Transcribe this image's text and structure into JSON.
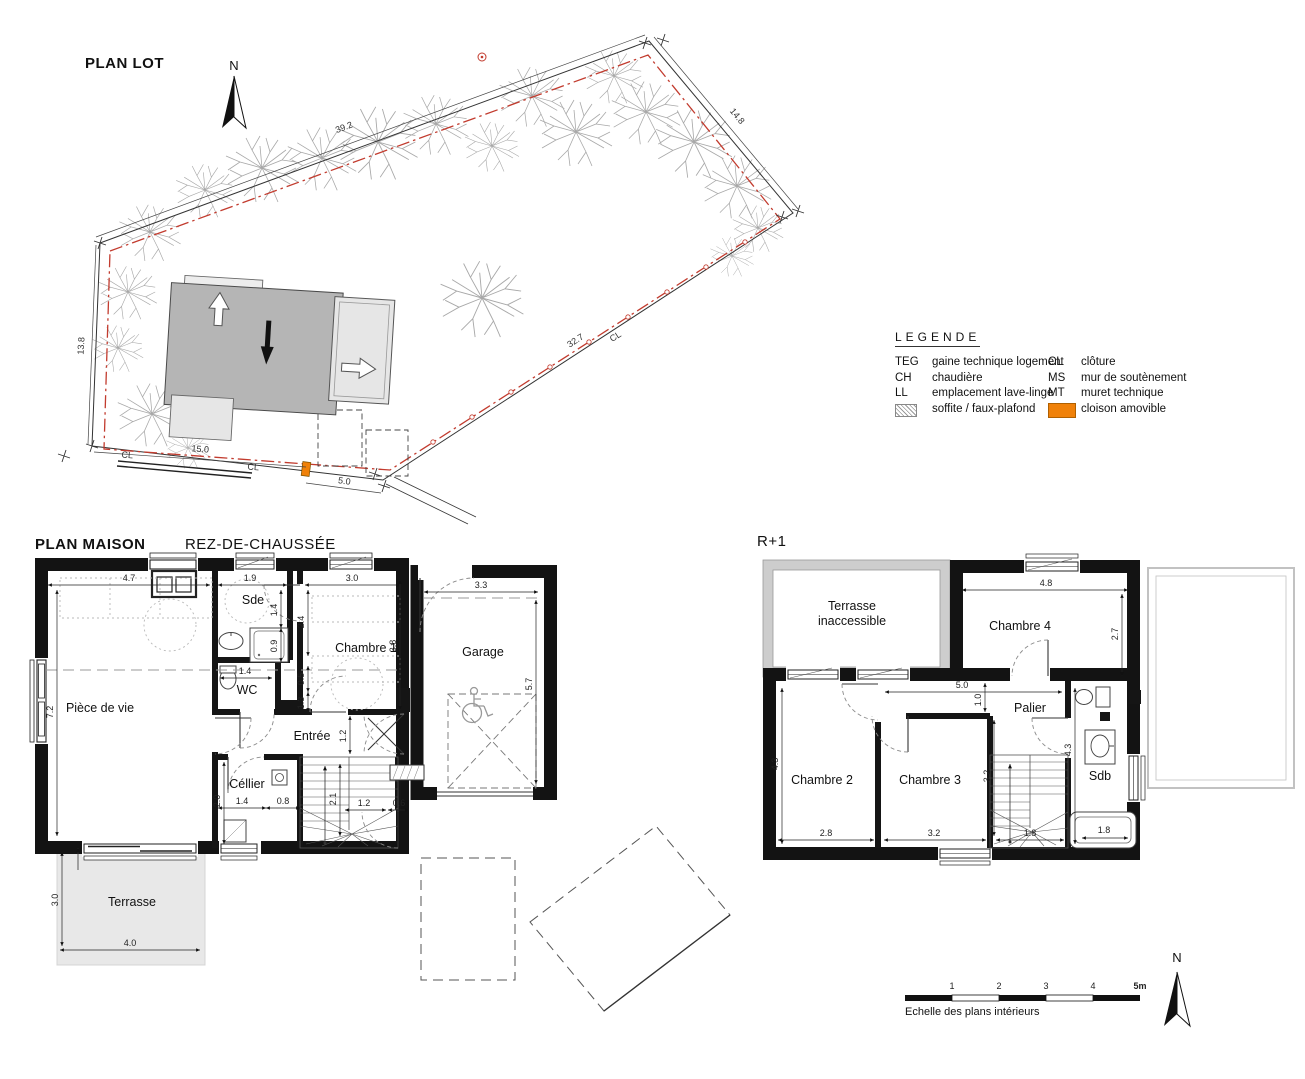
{
  "site_plan": {
    "title": "PLAN LOT",
    "north": "N",
    "dims": {
      "top_left": "39.2",
      "top_right": "14.8",
      "diagonal": "32.7",
      "left": "13.8",
      "bottom": "15.0",
      "gate": "5.0"
    },
    "fence_label": "CL"
  },
  "legend": {
    "title": "LEGENDE",
    "col1": [
      {
        "abbr": "TEG",
        "label": "gaine technique logement"
      },
      {
        "abbr": "CH",
        "label": "chaudière"
      },
      {
        "abbr": "LL",
        "label": "emplacement lave-linge"
      },
      {
        "abbr": "",
        "label": "soffite / faux-plafond"
      }
    ],
    "col2": [
      {
        "abbr": "CL",
        "label": "clôture"
      },
      {
        "abbr": "MS",
        "label": "mur de soutènement"
      },
      {
        "abbr": "MT",
        "label": "muret technique"
      },
      {
        "abbr": "",
        "label": "cloison amovible"
      }
    ],
    "swatch_orange": "#f08109"
  },
  "ground_floor": {
    "title": "PLAN MAISON",
    "subtitle": "REZ-DE-CHAUSSÉE",
    "rooms": {
      "living": "Pièce de vie",
      "sde": "Sde",
      "wc": "WC",
      "bed1": "Chambre 1",
      "entry": "Entrée",
      "cellar": "Céllier",
      "garage": "Garage",
      "terrace": "Terrasse"
    },
    "dims": {
      "living_w": "4.7",
      "sde_w": "1.9",
      "bed1_w": "3.0",
      "garage_w": "3.3",
      "sde_h": "1.4",
      "shower_h": "0.9",
      "bed1_d": "2.4",
      "bed1_h": "3.8",
      "garage_h": "5.7",
      "living_h": "7.2",
      "wc_w": "1.4",
      "wc_a": "0.5",
      "wc_b": "1.3",
      "entry_h": "1.2",
      "cellar_h": "2.0",
      "cellar_w": "1.4",
      "stair_w": "0.8",
      "stair_l": "2.1",
      "hall_w": "1.2",
      "niche_w": "0.6",
      "terrace_h": "3.0",
      "terrace_w": "4.0"
    }
  },
  "first_floor": {
    "title": "R+1",
    "rooms": {
      "terrace_l1": "Terrasse",
      "terrace_l2": "inaccessible",
      "bed4": "Chambre 4",
      "bed2": "Chambre 2",
      "bed3": "Chambre 3",
      "landing": "Palier",
      "bath": "Sdb"
    },
    "dims": {
      "bed4_w": "4.8",
      "bed4_h": "2.7",
      "landing_w": "5.0",
      "landing_d": "1.0",
      "bed2_h": "4.3",
      "bed2_w": "2.8",
      "bed3_w": "3.2",
      "bed3_h": "3.2",
      "stair_w": "1.8",
      "bath_h": "4.3",
      "tub_w": "1.8"
    }
  },
  "scale_bar": {
    "ticks": [
      "1",
      "2",
      "3",
      "4",
      "5m"
    ],
    "caption": "Echelle des plans intérieurs",
    "north": "N"
  }
}
